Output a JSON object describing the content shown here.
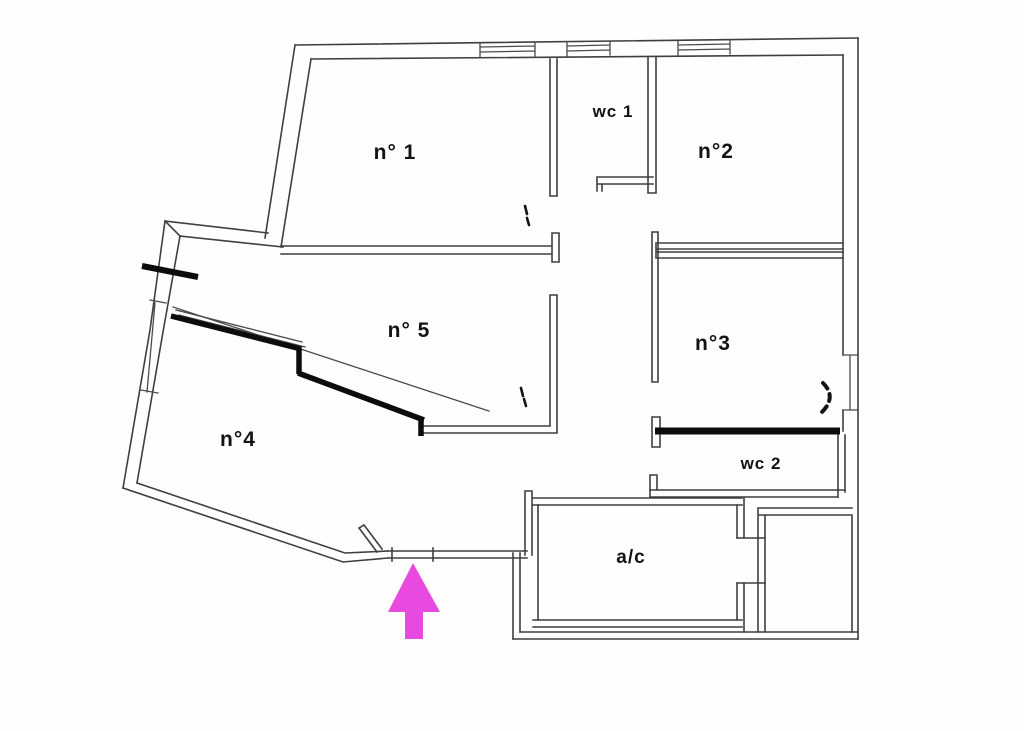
{
  "diagram": {
    "type": "floor-plan",
    "rooms": {
      "n1": {
        "label": "n° 1"
      },
      "n2": {
        "label": "n°2"
      },
      "n3": {
        "label": "n°3"
      },
      "n4": {
        "label": "n°4"
      },
      "n5": {
        "label": "n° 5"
      },
      "wc1": {
        "label": "wc 1"
      },
      "wc2": {
        "label": "wc 2"
      },
      "ac": {
        "label": "a/c"
      }
    },
    "entrance_arrow": {
      "direction": "up",
      "color": "#e84ae0"
    },
    "colors": {
      "wall": "#3f3f3f",
      "thick_wall": "#0c0c0c",
      "background": "#fefefe"
    }
  }
}
